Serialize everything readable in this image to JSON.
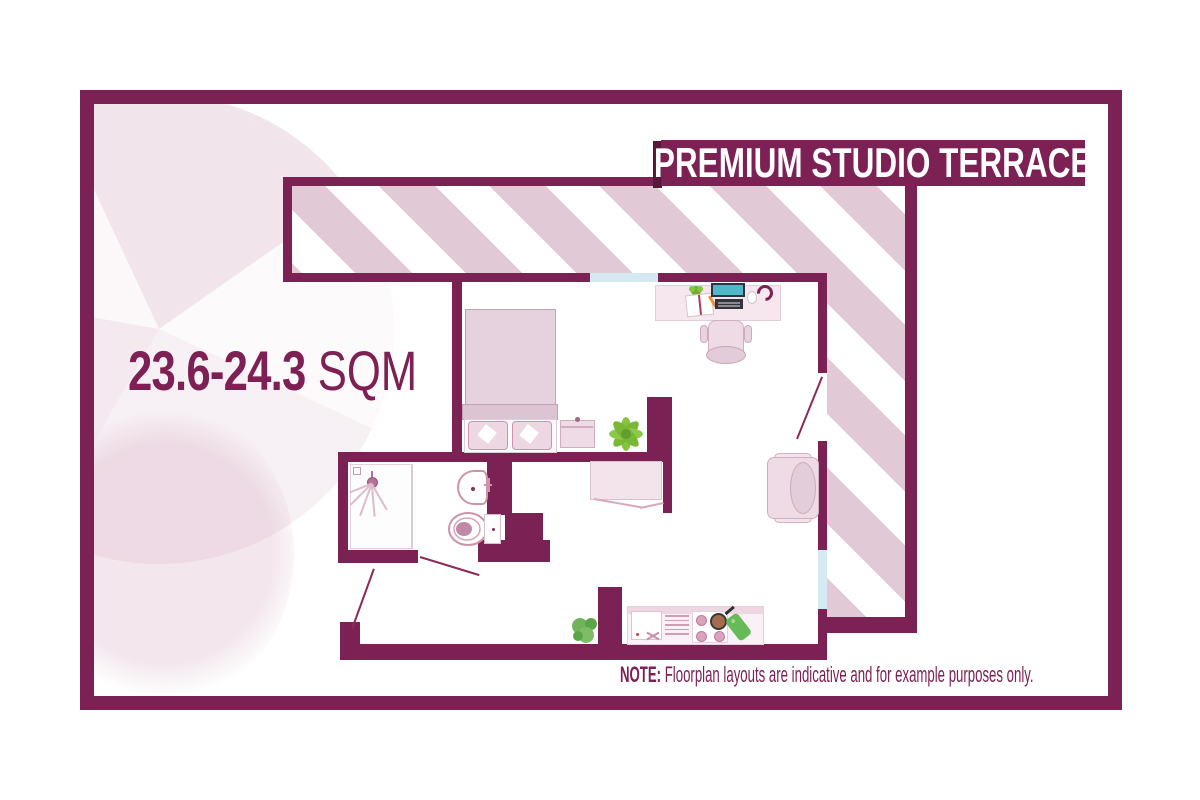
{
  "banner": {
    "title": "PREMIUM STUDIO TERRACE"
  },
  "area": {
    "range": "23.6-24.3",
    "unit": " SQM"
  },
  "note": {
    "label": "NOTE:",
    "text": "  Floorplan layouts are indicative and for example purposes only."
  },
  "colors": {
    "wall": "#7c2153",
    "stripe_pink": "#e1c9d5",
    "window_blue": "#d4e9f2",
    "accent_text": "#7d2154",
    "furniture_fill": "#eedbe6",
    "furniture_line": "#cfaec1",
    "plant_green": "#86c440",
    "laptop_screen_teal": "#4fb9c9"
  },
  "floorplan": {
    "rooms": [
      "terrace",
      "studio",
      "bathroom",
      "entrance-hall"
    ],
    "windows": 2,
    "doors": 3,
    "furniture": [
      "bed",
      "pillows",
      "bedside-table",
      "plant",
      "desk",
      "laptop",
      "book",
      "headphones",
      "mouse",
      "desk-chair",
      "armchair",
      "wardrobe",
      "shower",
      "washbasin",
      "toilet",
      "kitchenette",
      "hob",
      "kitchen-sink",
      "pan",
      "chopping-board",
      "small-plant"
    ]
  }
}
